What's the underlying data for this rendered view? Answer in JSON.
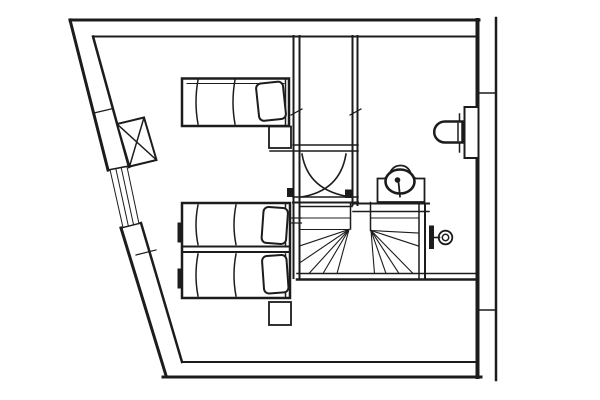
{
  "canvas": {
    "width": 600,
    "height": 400,
    "line_color": "#1c1c1c",
    "paper_color": "#ffffff"
  },
  "drawing": {
    "groups": [
      {
        "name": "outer-walls",
        "elements": [
          {
            "t": "line",
            "x1": 70,
            "y1": 20,
            "x2": 479,
            "y2": 20,
            "w": 3
          },
          {
            "t": "line",
            "x1": 93,
            "y1": 36.5,
            "x2": 477,
            "y2": 36.5,
            "w": 2
          },
          {
            "t": "line",
            "x1": 70,
            "y1": 20,
            "x2": 108,
            "y2": 170,
            "w": 3
          },
          {
            "t": "line",
            "x1": 93,
            "y1": 36.5,
            "x2": 129,
            "y2": 167,
            "w": 2.5
          },
          {
            "t": "line",
            "x1": 108,
            "y1": 170,
            "x2": 129,
            "y2": 166,
            "w": 1.5
          },
          {
            "t": "line",
            "x1": 94,
            "y1": 113,
            "x2": 113,
            "y2": 108.5,
            "w": 1.2
          },
          {
            "t": "line",
            "x1": 121,
            "y1": 228,
            "x2": 166,
            "y2": 375.5,
            "w": 3
          },
          {
            "t": "line",
            "x1": 141,
            "y1": 223,
            "x2": 182,
            "y2": 362,
            "w": 2.5
          },
          {
            "t": "line",
            "x1": 121,
            "y1": 228,
            "x2": 141,
            "y2": 223,
            "w": 1.5
          },
          {
            "t": "line",
            "x1": 136,
            "y1": 255,
            "x2": 156,
            "y2": 250,
            "w": 1.2
          },
          {
            "t": "line",
            "x1": 182,
            "y1": 362,
            "x2": 477,
            "y2": 362,
            "w": 2
          },
          {
            "t": "line",
            "x1": 163,
            "y1": 377,
            "x2": 481,
            "y2": 377,
            "w": 3
          },
          {
            "t": "line",
            "x1": 477.5,
            "y1": 20,
            "x2": 477.5,
            "y2": 377,
            "w": 4
          }
        ]
      },
      {
        "name": "party-wall",
        "elements": [
          {
            "t": "line",
            "x1": 496,
            "y1": 18,
            "x2": 496,
            "y2": 380,
            "w": 2.5
          },
          {
            "t": "line",
            "x1": 479,
            "y1": 93,
            "x2": 494.5,
            "y2": 93,
            "w": 1.5
          },
          {
            "t": "line",
            "x1": 479,
            "y1": 310,
            "x2": 494.5,
            "y2": 310,
            "w": 1.5
          }
        ]
      },
      {
        "name": "window-slanted-wall",
        "elements": [
          {
            "t": "line",
            "x1": 110,
            "y1": 169.6,
            "x2": 123,
            "y2": 227.5,
            "w": 1
          },
          {
            "t": "line",
            "x1": 115.8,
            "y1": 168.5,
            "x2": 128.4,
            "y2": 226.2,
            "w": 1
          },
          {
            "t": "line",
            "x1": 121.2,
            "y1": 167.5,
            "x2": 133.6,
            "y2": 225,
            "w": 1
          },
          {
            "t": "line",
            "x1": 126.9,
            "y1": 166.4,
            "x2": 139,
            "y2": 223.8,
            "w": 1
          }
        ]
      },
      {
        "name": "interior-walls",
        "elements": [
          {
            "t": "line",
            "x1": 293.5,
            "y1": 36,
            "x2": 293.5,
            "y2": 278,
            "w": 2
          },
          {
            "t": "line",
            "x1": 299.5,
            "y1": 36,
            "x2": 299.5,
            "y2": 278,
            "w": 2
          },
          {
            "t": "line",
            "x1": 352.5,
            "y1": 36,
            "x2": 352.5,
            "y2": 205,
            "w": 2
          },
          {
            "t": "line",
            "x1": 357.5,
            "y1": 36,
            "x2": 357.5,
            "y2": 205,
            "w": 2
          },
          {
            "t": "line",
            "x1": 291,
            "y1": 115,
            "x2": 302,
            "y2": 109,
            "w": 1.2
          },
          {
            "t": "line",
            "x1": 350,
            "y1": 115,
            "x2": 361,
            "y2": 109,
            "w": 1.2
          },
          {
            "t": "line",
            "x1": 291,
            "y1": 218,
            "x2": 301.5,
            "y2": 218,
            "w": 1.2
          },
          {
            "t": "line",
            "x1": 291,
            "y1": 223,
            "x2": 301.5,
            "y2": 223,
            "w": 1.2
          },
          {
            "t": "line",
            "x1": 293,
            "y1": 145,
            "x2": 358,
            "y2": 145,
            "w": 1.5
          },
          {
            "t": "line",
            "x1": 270,
            "y1": 151,
            "x2": 358,
            "y2": 151,
            "w": 1.5
          },
          {
            "t": "line",
            "x1": 293,
            "y1": 197,
            "x2": 358,
            "y2": 197,
            "w": 1.5
          },
          {
            "t": "line",
            "x1": 293,
            "y1": 202.5,
            "x2": 358,
            "y2": 202.5,
            "w": 2
          }
        ]
      },
      {
        "name": "double-leaf-door",
        "elements": [
          {
            "t": "path",
            "d": "M 302,154 Q 308,191 351,197",
            "w": 1.6
          },
          {
            "t": "path",
            "d": "M 346,154 Q 340,191 301,197",
            "w": 1.6
          },
          {
            "t": "rect",
            "x": 287,
            "y": 188,
            "wd": 6,
            "ht": 9,
            "fill": "ink"
          },
          {
            "t": "rect",
            "x": 345,
            "y": 189.5,
            "wd": 6.5,
            "ht": 8.5,
            "fill": "ink"
          }
        ]
      },
      {
        "name": "winder-staircase",
        "elements": [
          {
            "t": "line",
            "x1": 299.5,
            "y1": 206.5,
            "x2": 352,
            "y2": 206.5,
            "w": 1.5
          },
          {
            "t": "line",
            "x1": 353,
            "y1": 203.5,
            "x2": 429,
            "y2": 203.5,
            "w": 2
          },
          {
            "t": "line",
            "x1": 353,
            "y1": 211.5,
            "x2": 429,
            "y2": 211.5,
            "w": 1.5
          },
          {
            "t": "line",
            "x1": 350.5,
            "y1": 202.5,
            "x2": 350.5,
            "y2": 229,
            "w": 1.5
          },
          {
            "t": "line",
            "x1": 370.5,
            "y1": 202.5,
            "x2": 370.5,
            "y2": 230.5,
            "w": 1.5
          },
          {
            "t": "line",
            "x1": 299.5,
            "y1": 218,
            "x2": 350,
            "y2": 218,
            "w": 1.1
          },
          {
            "t": "line",
            "x1": 299.5,
            "y1": 229.5,
            "x2": 349,
            "y2": 229.5,
            "w": 1.1
          },
          {
            "t": "line",
            "x1": 349,
            "y1": 229.5,
            "x2": 299.5,
            "y2": 246,
            "w": 1.1
          },
          {
            "t": "line",
            "x1": 349,
            "y1": 229.5,
            "x2": 299.5,
            "y2": 263,
            "w": 1.1
          },
          {
            "t": "line",
            "x1": 349,
            "y1": 229.5,
            "x2": 309,
            "y2": 273.5,
            "w": 1.1
          },
          {
            "t": "line",
            "x1": 349,
            "y1": 229.5,
            "x2": 323,
            "y2": 273.5,
            "w": 1.1
          },
          {
            "t": "line",
            "x1": 349,
            "y1": 229.5,
            "x2": 337,
            "y2": 273.5,
            "w": 1.1
          },
          {
            "t": "line",
            "x1": 371,
            "y1": 218,
            "x2": 418.5,
            "y2": 218,
            "w": 1.1
          },
          {
            "t": "line",
            "x1": 371,
            "y1": 230.5,
            "x2": 418.5,
            "y2": 233,
            "w": 1.1
          },
          {
            "t": "line",
            "x1": 371,
            "y1": 230.5,
            "x2": 418.5,
            "y2": 246,
            "w": 1.1
          },
          {
            "t": "line",
            "x1": 371,
            "y1": 230.5,
            "x2": 413,
            "y2": 273.5,
            "w": 1.1
          },
          {
            "t": "line",
            "x1": 371,
            "y1": 230.5,
            "x2": 399,
            "y2": 273.5,
            "w": 1.1
          },
          {
            "t": "line",
            "x1": 371,
            "y1": 230.5,
            "x2": 386,
            "y2": 273.5,
            "w": 1.1
          },
          {
            "t": "line",
            "x1": 371,
            "y1": 230.5,
            "x2": 374.5,
            "y2": 273.5,
            "w": 1.1
          },
          {
            "t": "line",
            "x1": 419,
            "y1": 204,
            "x2": 419,
            "y2": 278,
            "w": 1.5
          },
          {
            "t": "line",
            "x1": 425,
            "y1": 204,
            "x2": 425,
            "y2": 278,
            "w": 2
          },
          {
            "t": "line",
            "x1": 297,
            "y1": 273.5,
            "x2": 477,
            "y2": 273.5,
            "w": 1.5
          },
          {
            "t": "line",
            "x1": 297,
            "y1": 279.5,
            "x2": 477,
            "y2": 279.5,
            "w": 2.5
          }
        ]
      },
      {
        "name": "stair-door-handle",
        "elements": [
          {
            "t": "rect",
            "x": 429,
            "y": 225.5,
            "wd": 5,
            "ht": 23.5,
            "fill": "ink"
          },
          {
            "t": "line",
            "x1": 434,
            "y1": 237.5,
            "x2": 439.5,
            "y2": 237.5,
            "w": 1.6
          },
          {
            "t": "circle",
            "cx": 445.5,
            "cy": 237.5,
            "r": 6.8,
            "w": 1.8
          },
          {
            "t": "circle",
            "cx": 445.5,
            "cy": 237.5,
            "r": 3.2,
            "w": 1.5
          }
        ]
      },
      {
        "name": "chimney-x-box",
        "elements": [
          {
            "t": "path",
            "d": "M 117,124 L 144,117.5 L 156.5,160 L 129.5,166.5 Z",
            "w": 2,
            "fill": "paper"
          },
          {
            "t": "line",
            "x1": 117,
            "y1": 124,
            "x2": 156.5,
            "y2": 160,
            "w": 1.5
          },
          {
            "t": "line",
            "x1": 144,
            "y1": 117.5,
            "x2": 129.5,
            "y2": 166.5,
            "w": 1.5
          }
        ]
      },
      {
        "name": "wash-basin",
        "elements": [
          {
            "t": "path",
            "d": "M 377.5,202 L 377.5,178.5 L 384,178.5 Q 388,178 390,172.5 Q 393.5,165.5 400.5,165.5 Q 407.5,165.5 410.5,172.5 Q 412.5,178 416.5,178.5 L 424.5,178.5 L 424.5,202 Z",
            "w": 1.8,
            "fill": "paper"
          },
          {
            "t": "ellipse",
            "cx": 400,
            "cy": 181.5,
            "rx": 14.5,
            "ry": 12,
            "w": 2.6,
            "fill": "paper"
          },
          {
            "t": "circle",
            "cx": 397.5,
            "cy": 180,
            "r": 2.8,
            "fill": "ink"
          },
          {
            "t": "line",
            "x1": 398.5,
            "y1": 182,
            "x2": 400,
            "y2": 196.5,
            "w": 1.8
          }
        ]
      },
      {
        "name": "toilet",
        "elements": [
          {
            "t": "rect",
            "x": 464.5,
            "y": 107,
            "wd": 14,
            "ht": 51,
            "w": 2,
            "fill": "paper"
          },
          {
            "t": "line",
            "x1": 459.5,
            "y1": 114,
            "x2": 459.5,
            "y2": 152,
            "w": 1.5
          },
          {
            "t": "path",
            "d": "M 462.5,121.5 L 445,121.5 A 10.8,10.5 0 0 0 445,142.5 L 462.5,142.5 Z",
            "w": 2.5,
            "fill": "paper"
          },
          {
            "t": "line",
            "x1": 458,
            "y1": 123.5,
            "x2": 458,
            "y2": 140.5,
            "w": 1.5
          }
        ]
      },
      {
        "name": "single-bed",
        "elements": [
          {
            "t": "rect",
            "x": 182,
            "y": 78.5,
            "wd": 107,
            "ht": 47.5,
            "w": 2.5,
            "fill": "paper"
          },
          {
            "t": "line",
            "x1": 187,
            "y1": 83.5,
            "x2": 284,
            "y2": 83.5,
            "w": 1
          },
          {
            "t": "path",
            "d": "M 198,80 Q 194,102 198,124",
            "w": 1.5
          },
          {
            "t": "path",
            "d": "M 235,80 Q 231,102 235,124",
            "w": 1.5
          },
          {
            "t": "line",
            "x1": 285.5,
            "y1": 80,
            "x2": 285.5,
            "y2": 124.5,
            "w": 1.5
          },
          {
            "t": "rect",
            "x": 257.5,
            "y": 82.5,
            "wd": 27,
            "ht": 37.5,
            "rx": 5,
            "w": 2,
            "fill": "paper",
            "rot": "-6 271 101"
          }
        ]
      },
      {
        "name": "twin-beds",
        "elements": [
          {
            "t": "rect",
            "x": 182,
            "y": 203,
            "wd": 108,
            "ht": 95,
            "w": 2.5,
            "fill": "paper"
          },
          {
            "t": "line",
            "x1": 182,
            "y1": 246.5,
            "x2": 290,
            "y2": 246.5,
            "w": 2
          },
          {
            "t": "line",
            "x1": 182,
            "y1": 252,
            "x2": 290,
            "y2": 252,
            "w": 2
          },
          {
            "t": "path",
            "d": "M 198,205 Q 194,225 198,244.5",
            "w": 1.5
          },
          {
            "t": "path",
            "d": "M 236,205 Q 232,225 236,244.5",
            "w": 1.5
          },
          {
            "t": "line",
            "x1": 285.5,
            "y1": 204.5,
            "x2": 285.5,
            "y2": 245,
            "w": 1.5
          },
          {
            "t": "rect",
            "x": 262.5,
            "y": 207.5,
            "wd": 24.5,
            "ht": 36,
            "rx": 5,
            "w": 2,
            "fill": "paper",
            "rot": "4 275 226"
          },
          {
            "t": "path",
            "d": "M 198,254 Q 194,275 198,296",
            "w": 1.5
          },
          {
            "t": "path",
            "d": "M 236,254 Q 232,275 236,296",
            "w": 1.5
          },
          {
            "t": "line",
            "x1": 285.5,
            "y1": 254,
            "x2": 285.5,
            "y2": 296.5,
            "w": 1.5
          },
          {
            "t": "rect",
            "x": 263,
            "y": 255.5,
            "wd": 24.5,
            "ht": 37.5,
            "rx": 5,
            "w": 2,
            "fill": "paper",
            "rot": "-4 275 274"
          },
          {
            "t": "rect",
            "x": 177.5,
            "y": 222.5,
            "wd": 4.5,
            "ht": 20,
            "fill": "ink"
          },
          {
            "t": "rect",
            "x": 177.5,
            "y": 268.5,
            "wd": 4.5,
            "ht": 20,
            "fill": "ink"
          }
        ]
      },
      {
        "name": "nightstands",
        "elements": [
          {
            "t": "rect",
            "x": 269,
            "y": 126.5,
            "wd": 22,
            "ht": 21.5,
            "w": 1.8,
            "fill": "paper"
          },
          {
            "t": "rect",
            "x": 269,
            "y": 302,
            "wd": 22,
            "ht": 23,
            "w": 1.8,
            "fill": "paper"
          }
        ]
      }
    ]
  }
}
